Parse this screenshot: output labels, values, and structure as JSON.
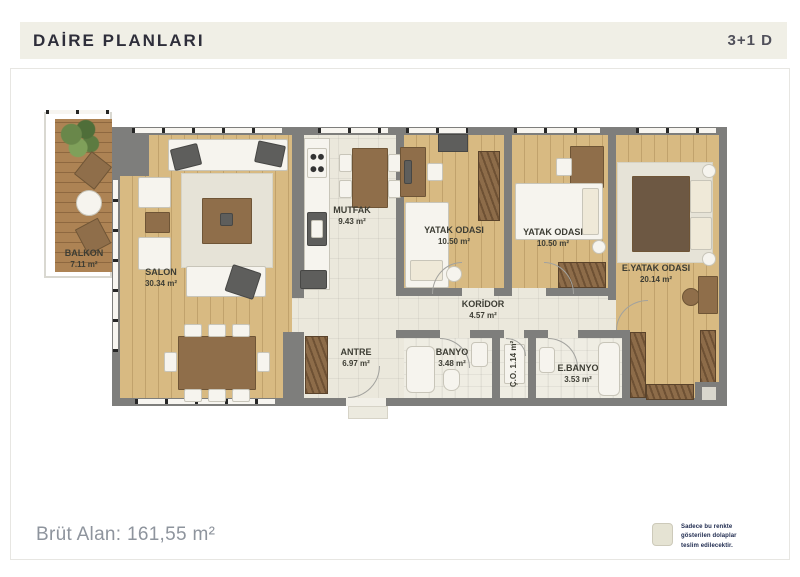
{
  "header": {
    "title": "DAİRE PLANLARI",
    "unit": "3+1 D"
  },
  "rooms": [
    {
      "name": "BALKON",
      "area": "7.11 m²"
    },
    {
      "name": "SALON",
      "area": "30.34 m²"
    },
    {
      "name": "MUTFAK",
      "area": "9.43 m²"
    },
    {
      "name": "YATAK ODASI",
      "area": "10.50 m²"
    },
    {
      "name": "YATAK ODASI",
      "area": "10.50 m²"
    },
    {
      "name": "E.YATAK ODASI",
      "area": "20.14 m²"
    },
    {
      "name": "KORİDOR",
      "area": "4.57 m²"
    },
    {
      "name": "ANTRE",
      "area": "6.97 m²"
    },
    {
      "name": "BANYO",
      "area": "3.48 m²"
    },
    {
      "name": "Ç.O.",
      "area": "1.14 m²"
    },
    {
      "name": "E.BANYO",
      "area": "3.53 m²"
    }
  ],
  "footer": {
    "gross_area": "Brüt Alan: 161,55 m²",
    "legend_lines": [
      "Sadece bu renkte",
      "gösterilen dolaplar",
      "teslim edilecektir."
    ]
  },
  "colors": {
    "header_band": "#f0efe6",
    "wall_gray": "#7e7e7c",
    "wood_floor": "#d8ba82",
    "balcony_wood": "#ad8354",
    "tile_floor": "#ebe8dc",
    "legend_swatch": "#e5e3d3",
    "legend_text": "#202c50",
    "footer_text": "#8e949d"
  }
}
